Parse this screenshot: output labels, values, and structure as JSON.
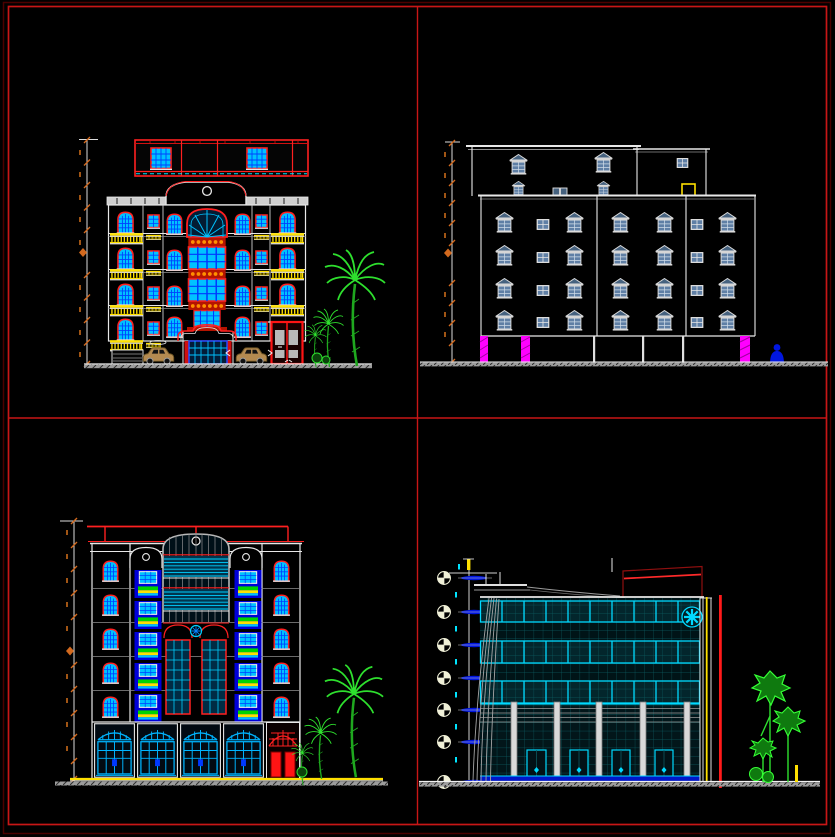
{
  "sheet": {
    "width_px": 835,
    "height_px": 837,
    "background": "#000000",
    "frame_color": "#c81616",
    "frame_shadow_color": "#4a0000",
    "layout": "four architectural elevation drawings arranged in a 2x2 grid separated by red divider lines"
  },
  "palette": {
    "red": "#ff2020",
    "dark_red": "#b51400",
    "cyan_glass": "#00c2ff",
    "bright_cyan": "#00d9ff",
    "teal_grid": "#0c5a60",
    "blue_mullion": "#0038ff",
    "royal_blue": "#0000d8",
    "steel_blue": "#5f7fa5",
    "yellow": "#ffe000",
    "magenta": "#ff00ff",
    "orange_ornament": "#ff9000",
    "dimension_orange": "#d2691e",
    "green": "#1fa81f",
    "bright_green": "#2ee02e",
    "line_white": "#e8e8e8",
    "ground_gray": "#9c9c9c",
    "car_tan": "#b48a50"
  },
  "drawings": {
    "top_left": {
      "label": "Front elevation - classical apartment building with red penthouse, cyan windows, yellow balconies, arched entrance, two cars and palm trees",
      "floors_visible": 4,
      "penthouse": true,
      "window_finish": "cyan glazing with red frames and blue mullions",
      "balcony_finish": "yellow railings",
      "dimension_line": "vertical with orange ticks"
    },
    "top_right": {
      "label": "Side elevation - masonry block with pediment-top steel blue windows, open pilotis with magenta hatched columns and a blue human figure",
      "floors_visible": 4,
      "window_finish": "steel blue glazing, white pediment frames",
      "rooftop_detail": "yellow opening outline",
      "dimension_line": "vertical with orange ticks"
    },
    "bottom_left": {
      "label": "Rear elevation - five floor facade with curved-top glazed tower, green and yellow planters on royal blue recesses, four cyan arched storefronts and red side door, palm trees",
      "floors_visible": 5,
      "rooftop_detail": "red pergola line",
      "ground_floor": "cyan arched storefront bays plus red door bay",
      "dimension_line": "vertical with orange ticks"
    },
    "bottom_right": {
      "label": "Modern elevation - teal curtain wall grid with bright cyan window bands, cyan rosette, red roof feature, red and yellow edge lines, glazed ground floor with light columns, level datum markers and green trees",
      "floors_visible": 3,
      "level_markers": 7,
      "ground_floor": "glazed storefront, five light columns, blue base strip",
      "dimension_line": "level datum circles with blue level dashes"
    }
  }
}
